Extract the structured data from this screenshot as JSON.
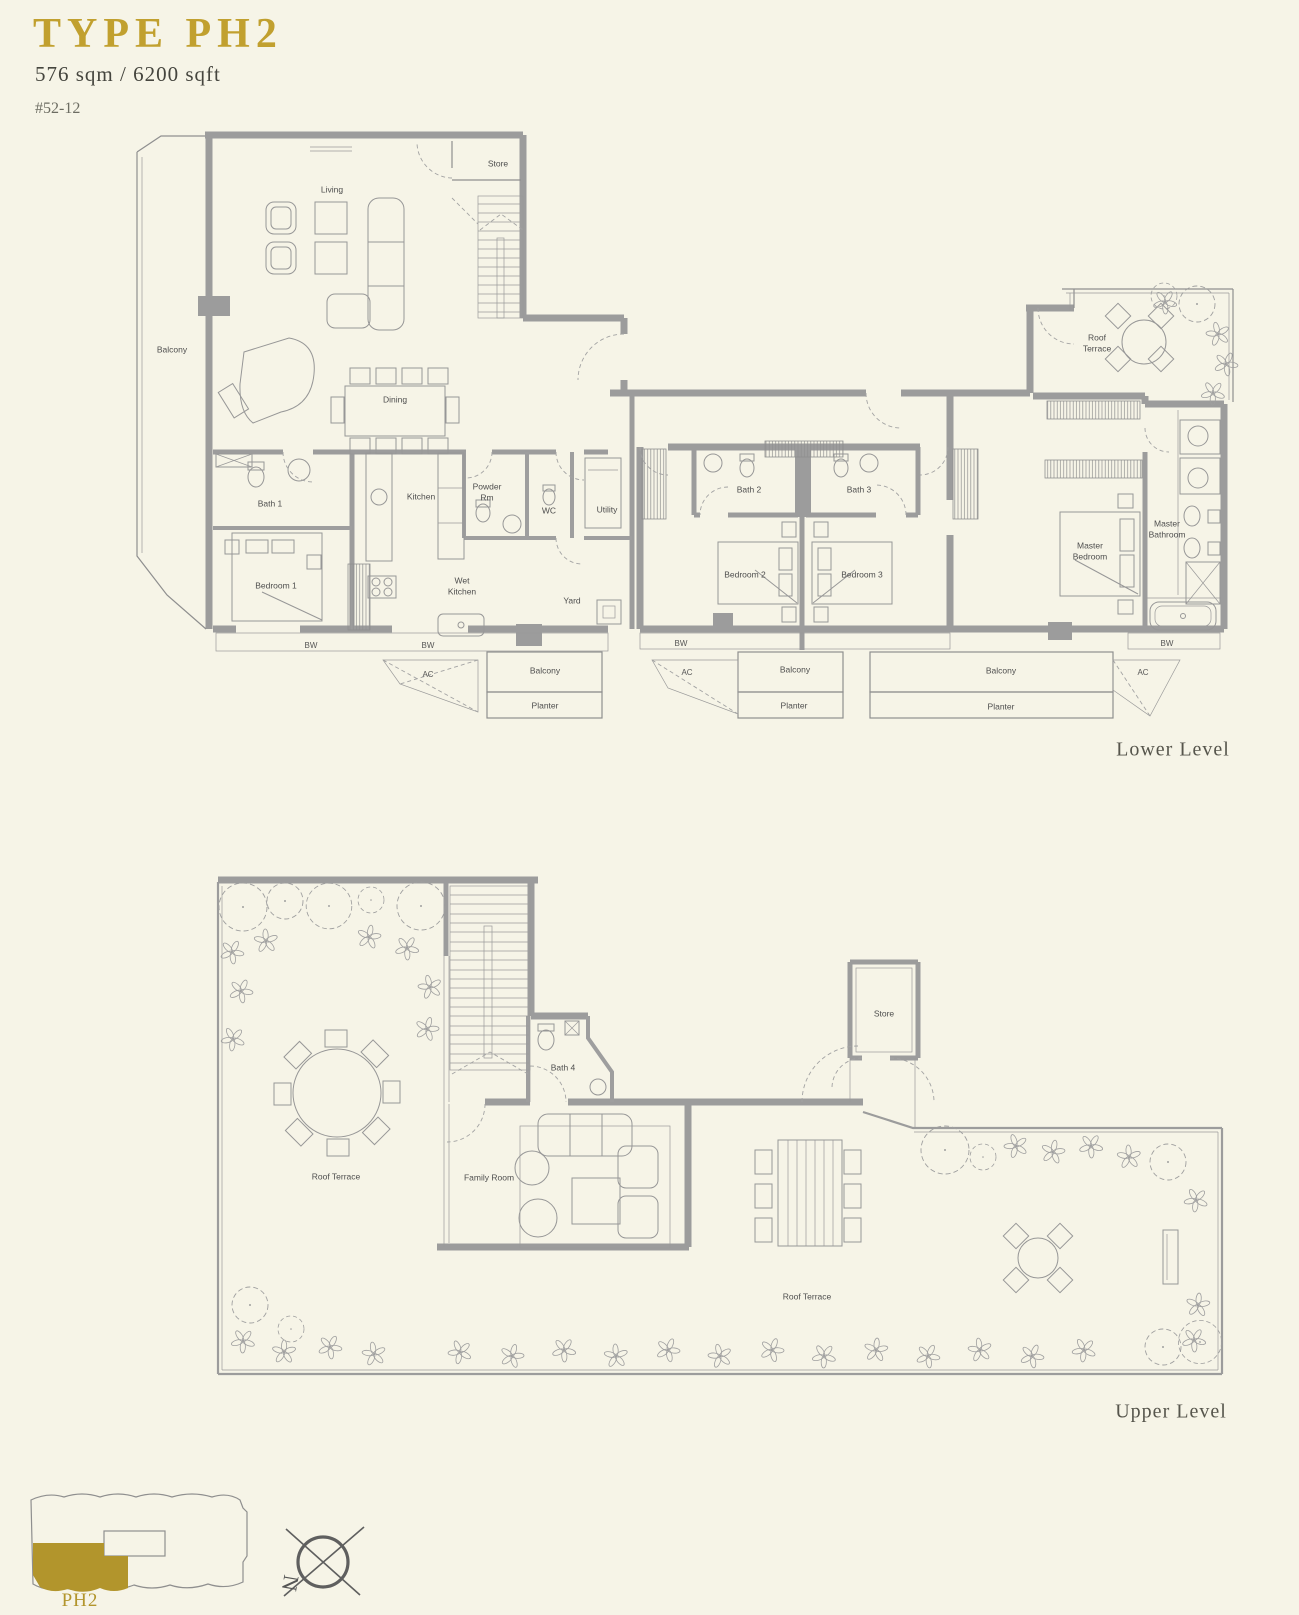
{
  "header": {
    "title": "TYPE PH2",
    "area": "576 sqm / 6200 sqft",
    "unit": "#52-12"
  },
  "lower_level": {
    "caption": "Lower Level",
    "rooms": {
      "living": "Living",
      "dining": "Dining",
      "balcony": "Balcony",
      "store": "Store",
      "bath1": "Bath 1",
      "bedroom1": "Bedroom 1",
      "kitchen": "Kitchen",
      "wet_kitchen": "Wet Kitchen",
      "powder_rm": "Powder Rm",
      "wc": "WC",
      "utility": "Utility",
      "yard": "Yard",
      "bath2": "Bath 2",
      "bath3": "Bath 3",
      "bedroom2": "Bedroom 2",
      "bedroom3": "Bedroom 3",
      "master_bedroom": "Master Bedroom",
      "master_bathroom": "Master Bathroom",
      "roof_terrace": "Roof Terrace"
    },
    "annotations": {
      "bw": "BW",
      "ac": "AC",
      "balcony": "Balcony",
      "planter": "Planter"
    }
  },
  "upper_level": {
    "caption": "Upper Level",
    "rooms": {
      "roof_terrace": "Roof Terrace",
      "family_room": "Family Room",
      "bath4": "Bath 4",
      "store": "Store",
      "roof_terrace_right": "Roof Terrace"
    }
  },
  "key_plan": {
    "unit": "PH2"
  },
  "compass": {
    "north": "N"
  },
  "colors": {
    "accent_gold": "#c1a02f",
    "keyplan_gold": "#b2952c",
    "wall_gray": "#9c9c9c",
    "line_gray": "#8f8f8f",
    "text_gray": "#4e4e4e",
    "background": "#f6f4e7"
  }
}
